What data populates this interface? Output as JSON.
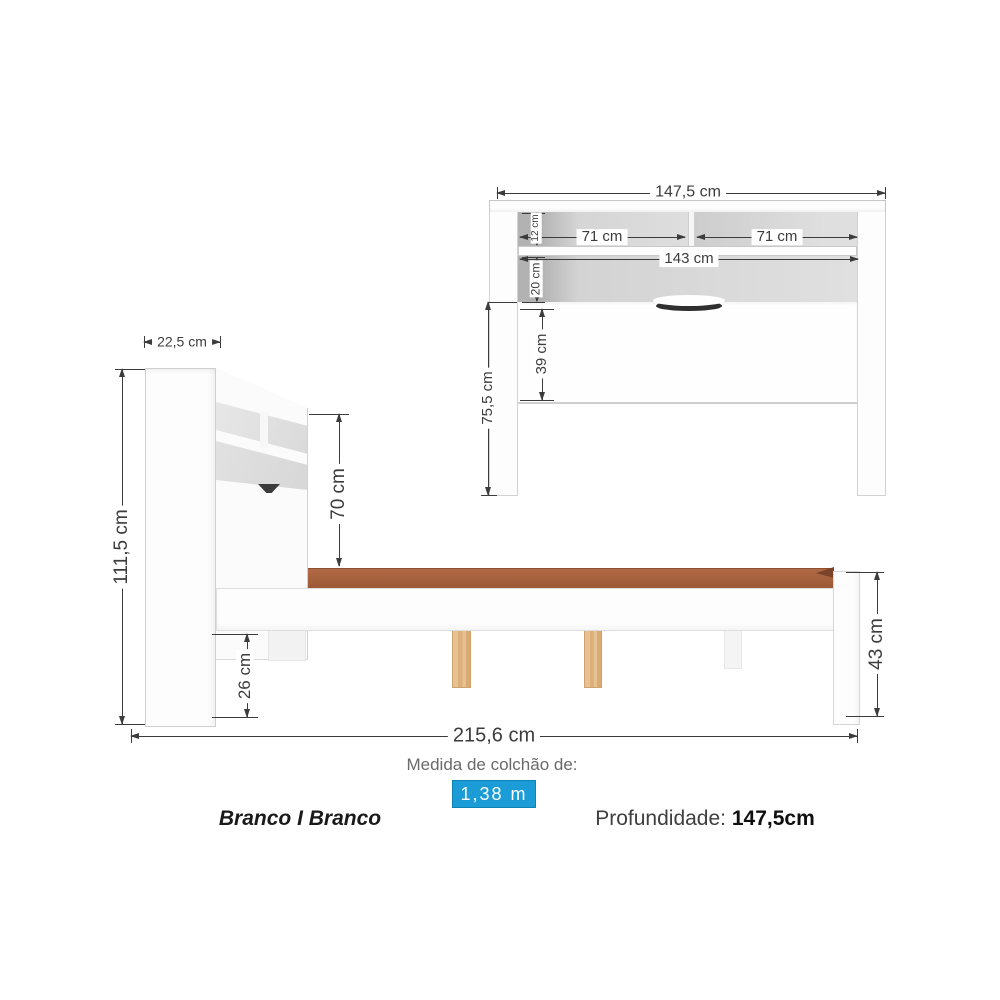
{
  "front_view": {
    "total_width": "147,5 cm",
    "left_shelf_width": "71 cm",
    "right_shelf_width": "71 cm",
    "inner_width": "143 cm",
    "top_shelf_height": "12 cm",
    "niche_height": "20 cm",
    "panel_height": "39 cm",
    "leg_height": "75,5 cm"
  },
  "side_view": {
    "headboard_depth": "22,5 cm",
    "total_height": "111,5 cm",
    "headboard_above_base": "70 cm",
    "clearance_height": "26 cm",
    "total_length": "215,6 cm",
    "footboard_height": "43 cm"
  },
  "footer": {
    "mattress_label": "Medida de colchão de:",
    "mattress_size": "1,38 m",
    "finish": "Branco I Branco",
    "depth_label": "Profundidade:",
    "depth_value": "147,5cm"
  },
  "colors": {
    "accent": "#1b9cd7",
    "dim": "#3c3c3c",
    "wood_platform": "#b06a45",
    "wood_leg": "#e6c193"
  }
}
